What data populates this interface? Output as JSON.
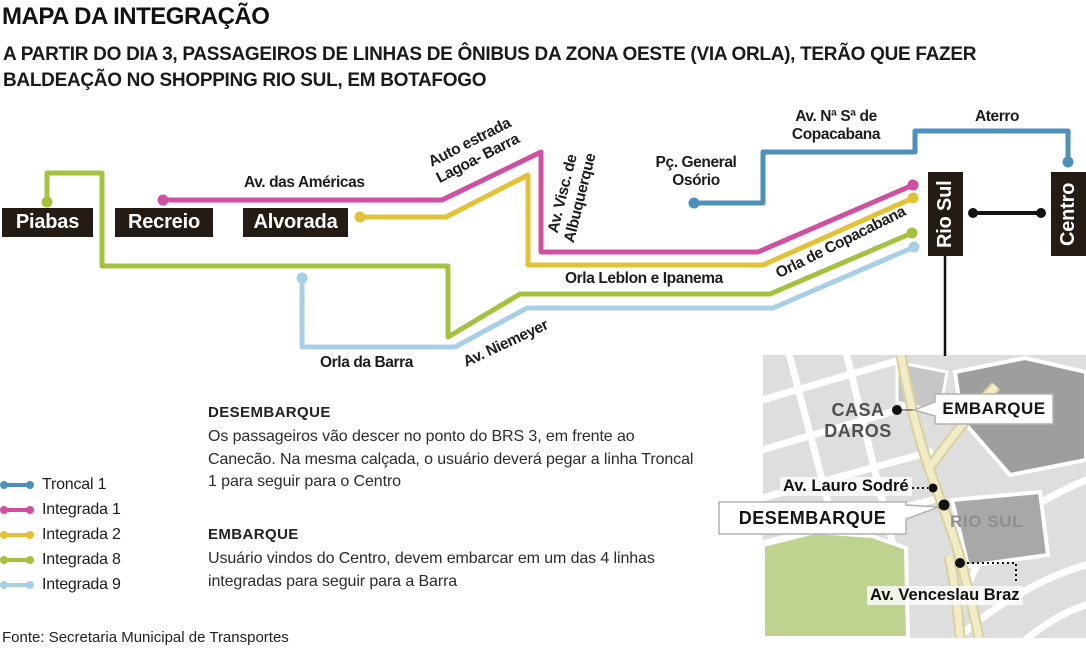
{
  "header": {
    "title": "MAPA DA INTEGRAÇÃO",
    "subtitle": "A PARTIR DO DIA 3, PASSAGEIROS DE LINHAS DE ÔNIBUS DA ZONA OESTE (VIA ORLA), TERÃO QUE FAZER BALDEAÇÃO NO SHOPPING RIO SUL, EM BOTAFOGO"
  },
  "stations": {
    "piabas": "Piabas",
    "recreio": "Recreio",
    "alvorada": "Alvorada",
    "rio_sul": "Rio Sul",
    "centro": "Centro"
  },
  "route_labels": {
    "av_das_americas": "Av. das Américas",
    "auto_estrada_l1": "Auto estrada",
    "auto_estrada_l2": "Lagoa- Barra",
    "av_visc_l1": "Av. Visc. de",
    "av_visc_l2": "Albuquerque",
    "pc_osorio_l1": "Pç. General",
    "pc_osorio_l2": "Osório",
    "av_ns_copacabana_l1": "Av. Nª Sª de",
    "av_ns_copacabana_l2": "Copacabana",
    "aterro": "Aterro",
    "orla_leblon": "Orla Leblon e Ipanema",
    "orla_copacabana": "Orla de Copacabana",
    "orla_da_barra": "Orla da Barra",
    "av_niemeyer": "Av. Niemeyer"
  },
  "legend": {
    "items": [
      {
        "id": "troncal1",
        "label": "Troncal 1",
        "color": "#4d90bd"
      },
      {
        "id": "integrada1",
        "label": "Integrada 1",
        "color": "#d04fa1"
      },
      {
        "id": "integrada2",
        "label": "Integrada 2",
        "color": "#e4c237"
      },
      {
        "id": "integrada8",
        "label": "Integrada 8",
        "color": "#a5c23f"
      },
      {
        "id": "integrada9",
        "label": "Integrada 9",
        "color": "#a9cfe7"
      }
    ]
  },
  "notes": {
    "desembarque_title": "DESEMBARQUE",
    "desembarque_body": "Os passageiros vão descer no ponto do BRS 3, em frente ao Canecão. Na mesma calçada, o usuário deverá pegar a linha Troncal 1 para seguir para o Centro",
    "embarque_title": "EMBARQUE",
    "embarque_body": "Usuário vindos do Centro, devem embarcar em um das 4 linhas integradas para seguir para a Barra"
  },
  "inset_map": {
    "casa_daros_l1": "CASA",
    "casa_daros_l2": "DAROS",
    "embarque_callout": "EMBARQUE",
    "desembarque_callout": "DESEMBARQUE",
    "av_lauro_sodre": "Av. Lauro Sodré",
    "rio_sul_area": "RIO SUL",
    "av_venceslau_braz": "Av. Venceslau Braz"
  },
  "footer": {
    "source": "Fonte: Secretaria Municipal de Transportes"
  },
  "colors": {
    "station-box": "#241b14",
    "text": "#1d1d1b",
    "connector-black": "#111111",
    "map-bg": "#dedede",
    "map-dark": "#9e9e9e",
    "map-dark2": "#a8a8a8",
    "map-road": "#f2ecc6",
    "map-road-edge": "#d9d0a0",
    "map-park": "#bfd390",
    "callout-border": "#b3b3b3"
  }
}
